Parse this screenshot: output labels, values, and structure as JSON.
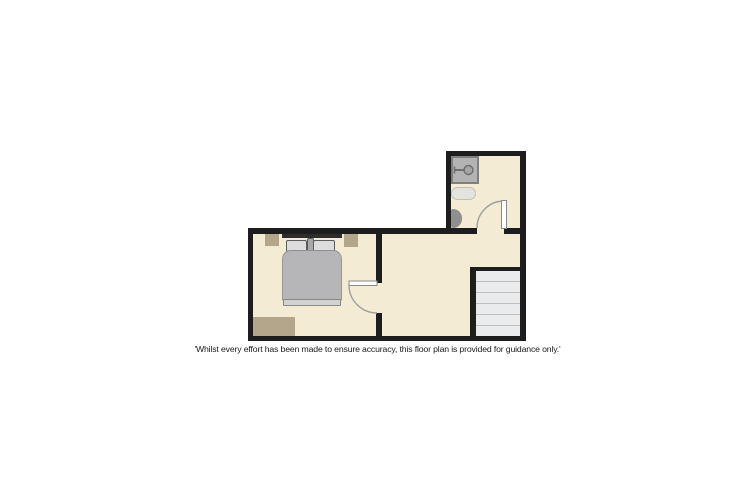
{
  "disclaimer": "'Whilst every effort has been made to ensure accuracy, this floor plan is provided for guidance only.'",
  "colors": {
    "background": "#ffffff",
    "floor": "#f4ebd5",
    "wall": "#1d1d1d",
    "tan_furniture": "#b3a68a",
    "headboard": "#2d2d2d",
    "pillow": "#dddddd",
    "duvet": "#b6b6b8",
    "footboard": "#d2d2d2",
    "shower": "#b3b3b3",
    "shower_border": "#7f7f7f",
    "toilet": "#e4e4de",
    "sink": "#8f8f8f",
    "stair_tread": "#eaebec",
    "stair_line": "#bfbfbf",
    "door_line": "#9f9f9f",
    "text": "#1b1b1b"
  },
  "stairs": {
    "tread_count": 6
  },
  "fixtures": {
    "bathroom": [
      "shower",
      "toilet",
      "wash-basin",
      "door"
    ],
    "bedroom": [
      "double-bed",
      "nightstand-left",
      "nightstand-right",
      "rug",
      "door"
    ],
    "landing": [
      "staircase"
    ]
  }
}
